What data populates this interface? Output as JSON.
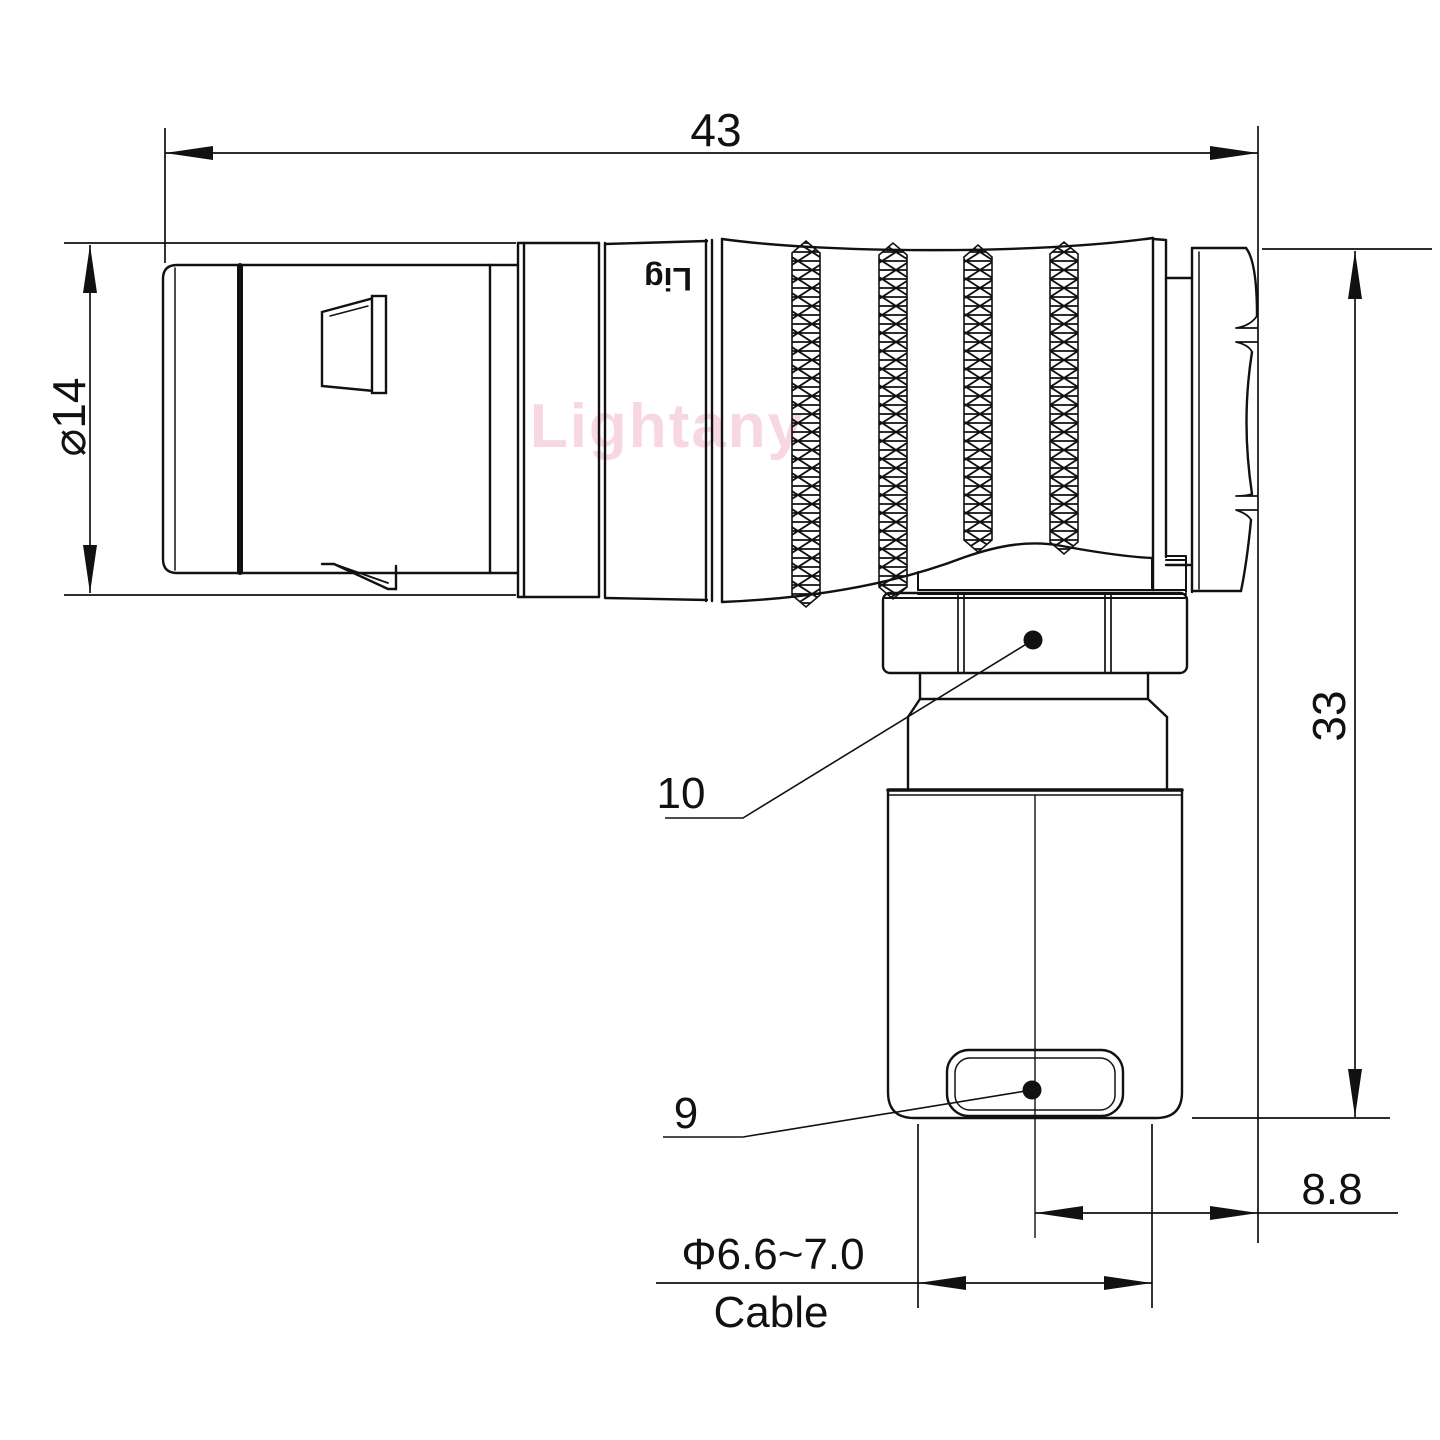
{
  "drawing": {
    "watermark": "Lightany",
    "barrel_engraving": "Lig",
    "colors": {
      "line": "#111111",
      "watermark_pink": "#f2b9c7"
    },
    "dimensions": {
      "overall_length": "43",
      "front_diameter": "⌀14",
      "overall_height": "33",
      "nut_offset": "8.8",
      "cable_diameter": "Φ6.6~7.0",
      "cable_label": "Cable"
    },
    "part_labels": {
      "coupling_nut": "10",
      "crimp_sleeve": "9"
    }
  }
}
